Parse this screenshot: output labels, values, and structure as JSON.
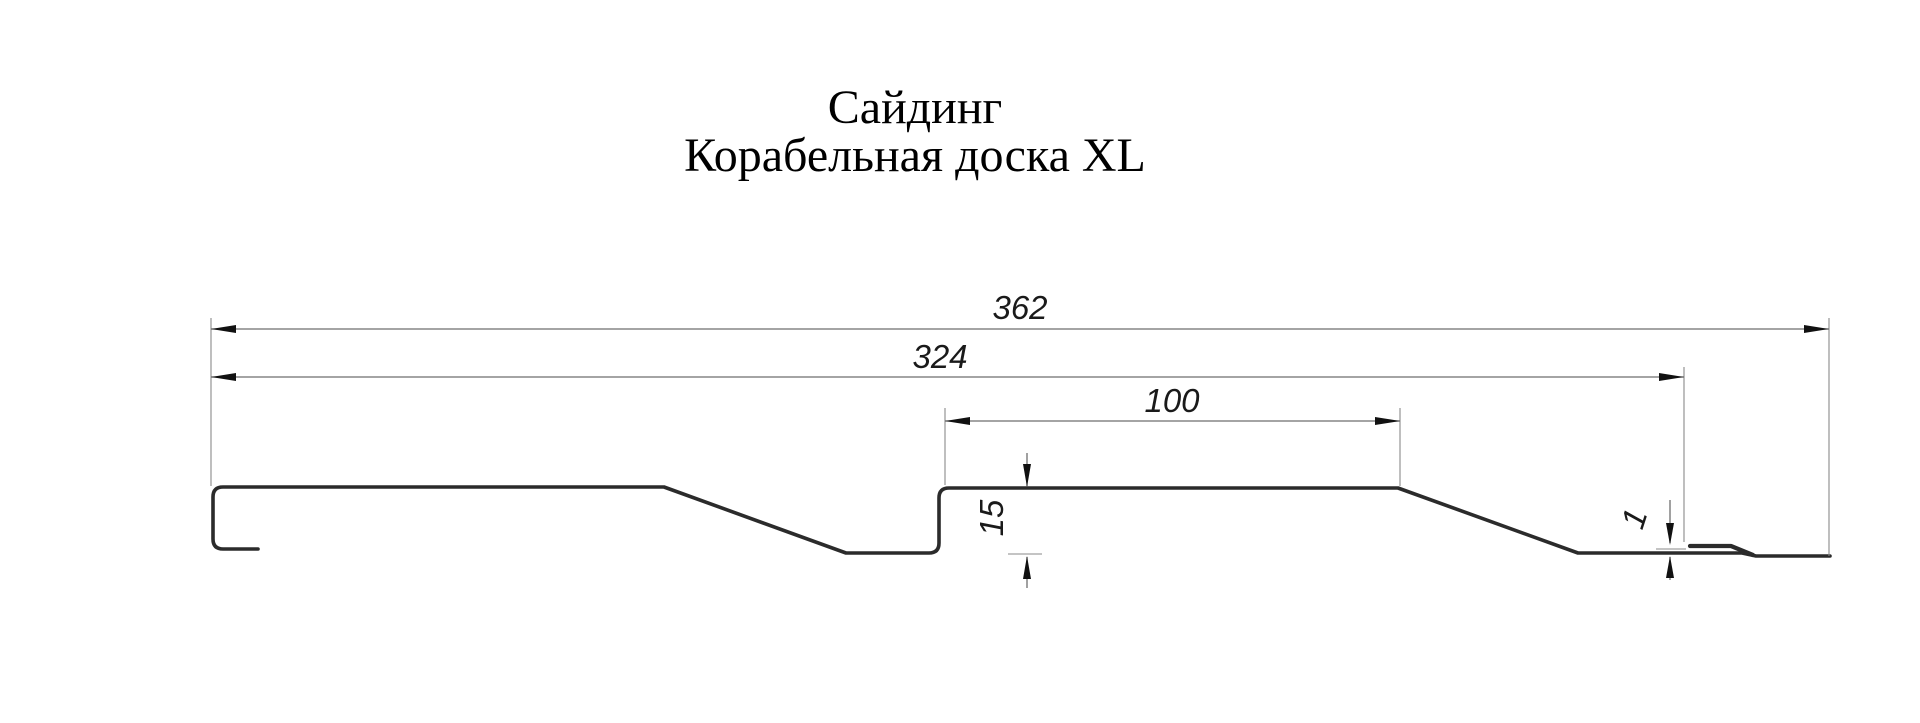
{
  "title": {
    "line1": "Сайдинг",
    "line2": "Корабельная доска XL"
  },
  "drawing": {
    "kind": "profile-cross-section",
    "dimensions": {
      "overall_width": "362",
      "cover_width": "324",
      "plank_width": "100",
      "profile_depth": "15",
      "lock_step": "1"
    },
    "colors": {
      "background": "#ffffff",
      "profile_line": "#2b2b2b",
      "dimension_line": "#6e6e6e",
      "extension_line": "#8a8a8a",
      "arrow": "#111111",
      "text": "#000000"
    }
  }
}
